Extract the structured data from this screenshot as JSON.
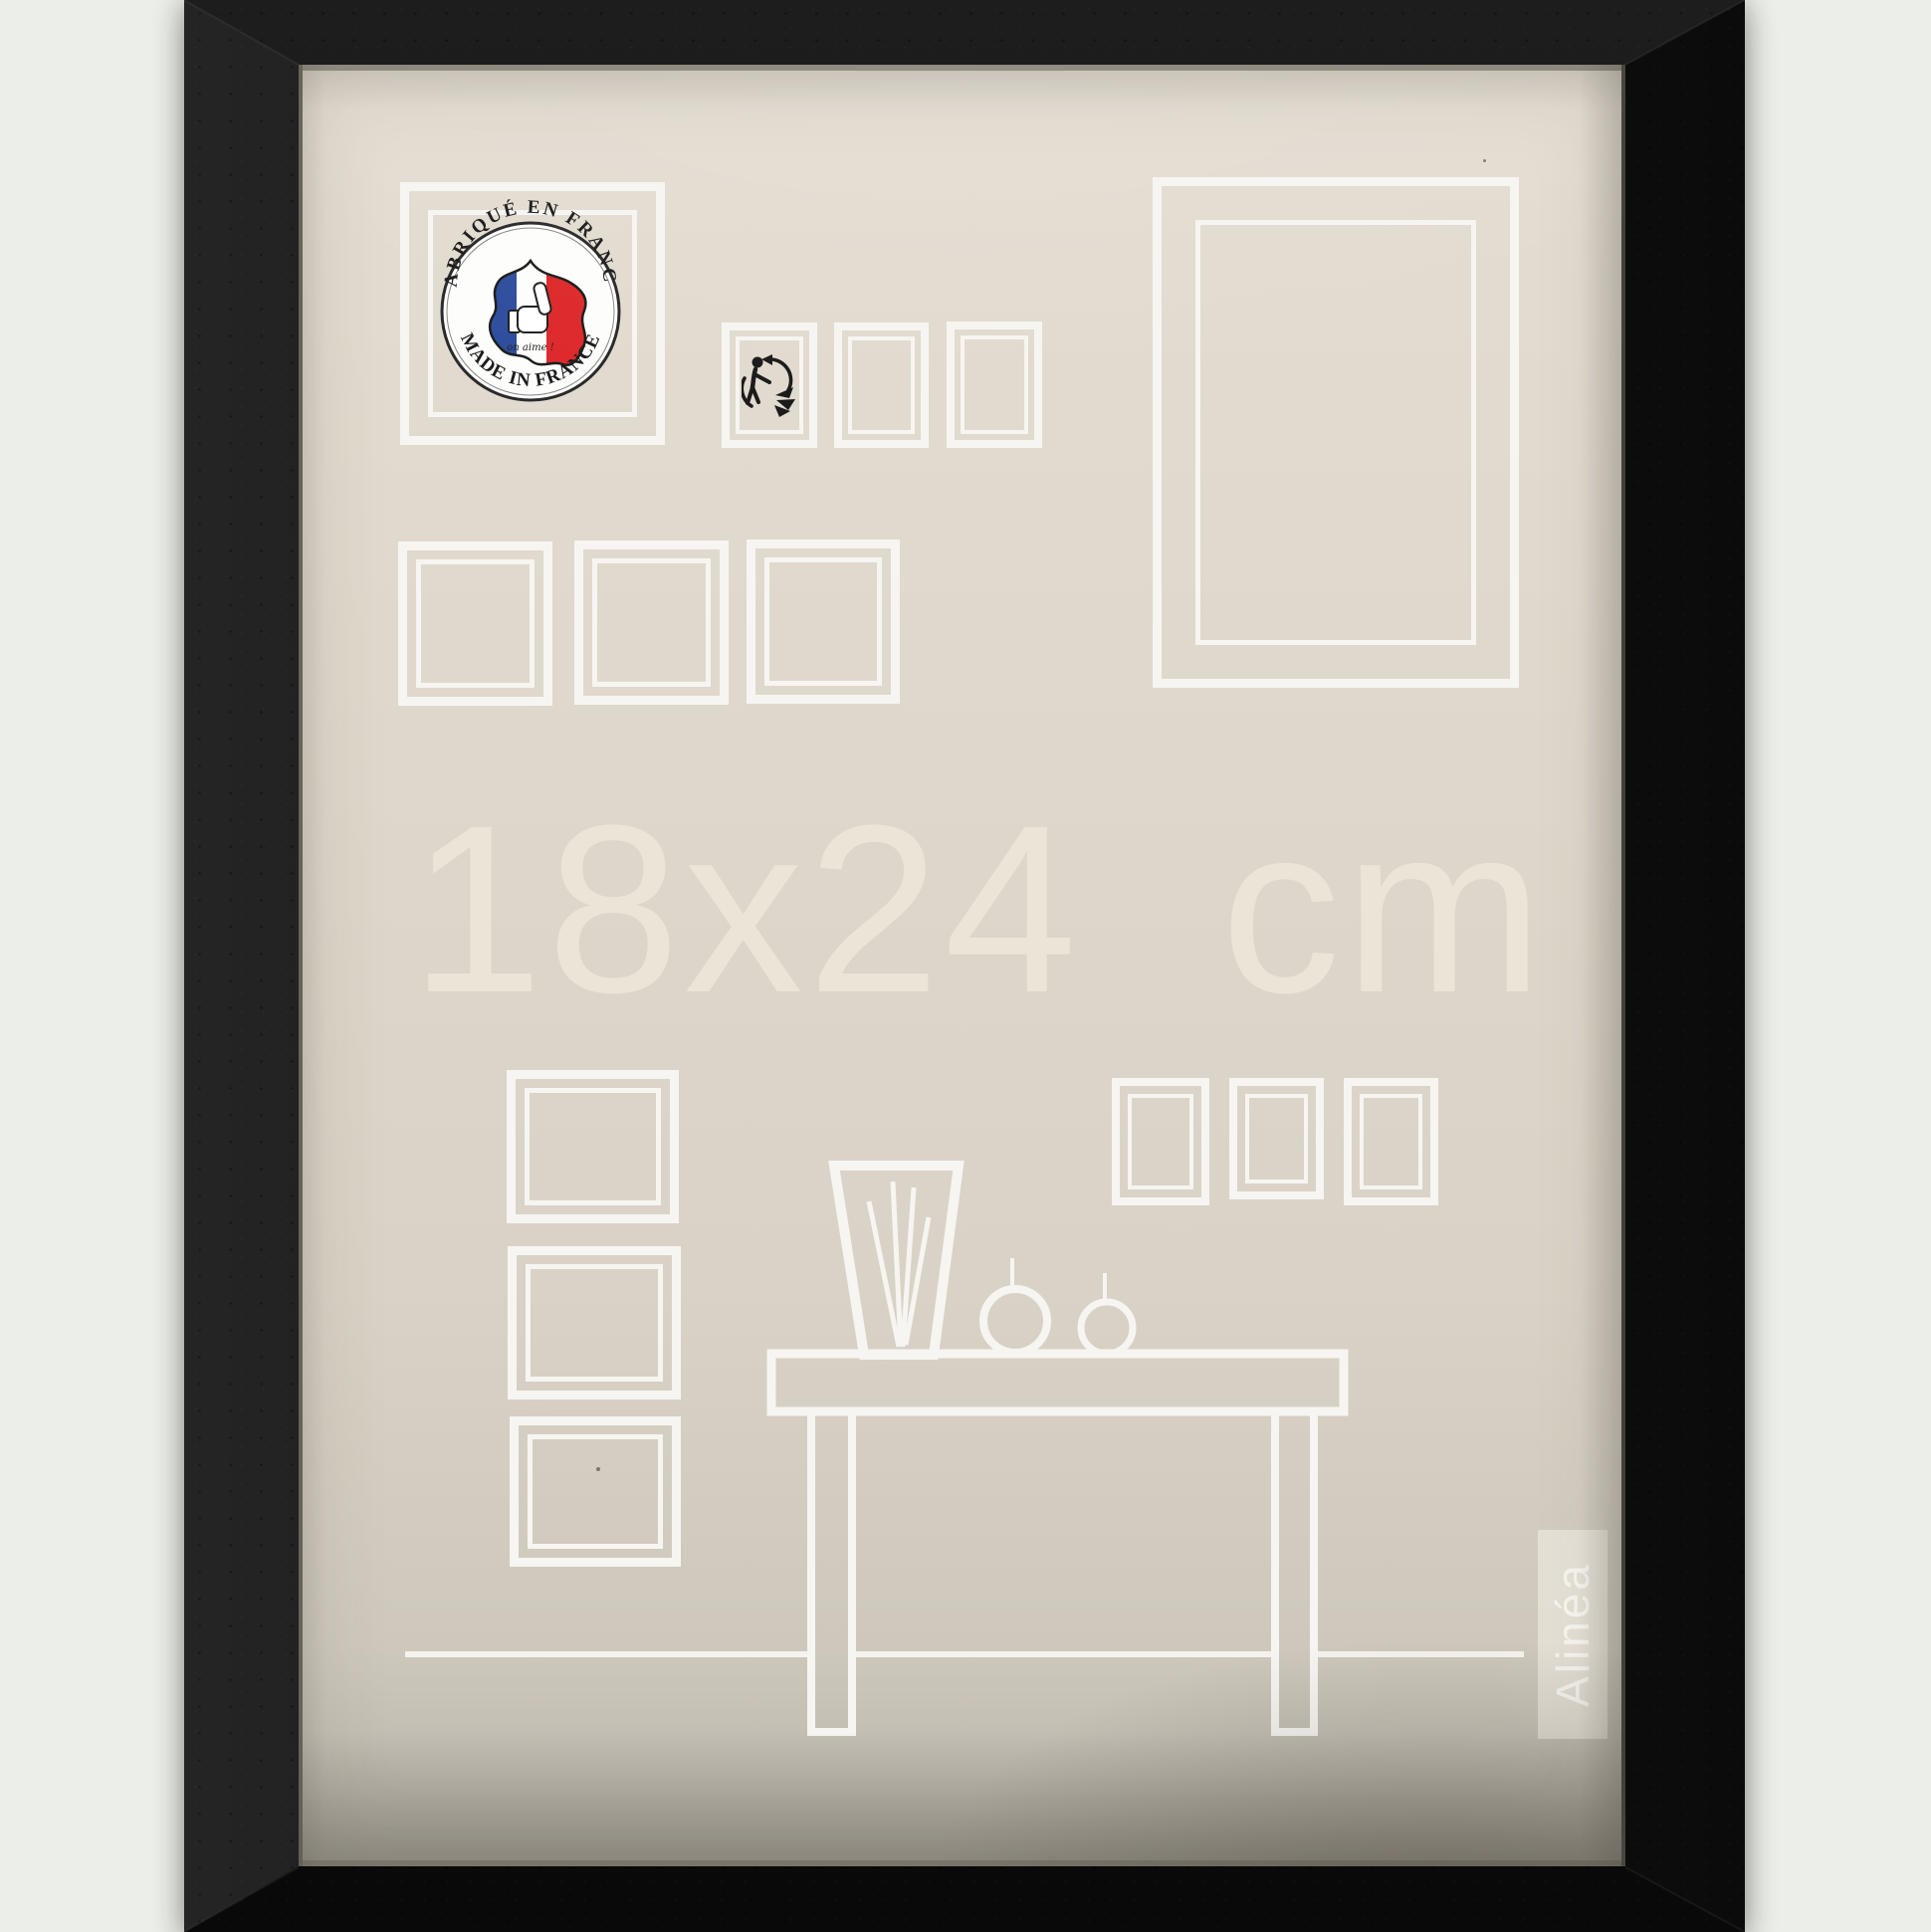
{
  "product": {
    "size_label": "18x24 cm",
    "brand": "Alinéa"
  },
  "badge": {
    "top_text": "FABRIQUÉ EN FRANCE",
    "bottom_text": "MADE IN FRANCE",
    "script_text": "on aime !"
  },
  "icons": {
    "badge": "made-in-france-badge",
    "recycling": "triman-recycling-icon"
  },
  "colors": {
    "page_background": "#ecefe9",
    "frame_black": "#141414",
    "mat_beige": "#ddd6ca",
    "line_white": "#f7f5f1",
    "size_text": "#ece6d9",
    "flag_blue": "#2f4f9e",
    "flag_red": "#de2a2c"
  }
}
